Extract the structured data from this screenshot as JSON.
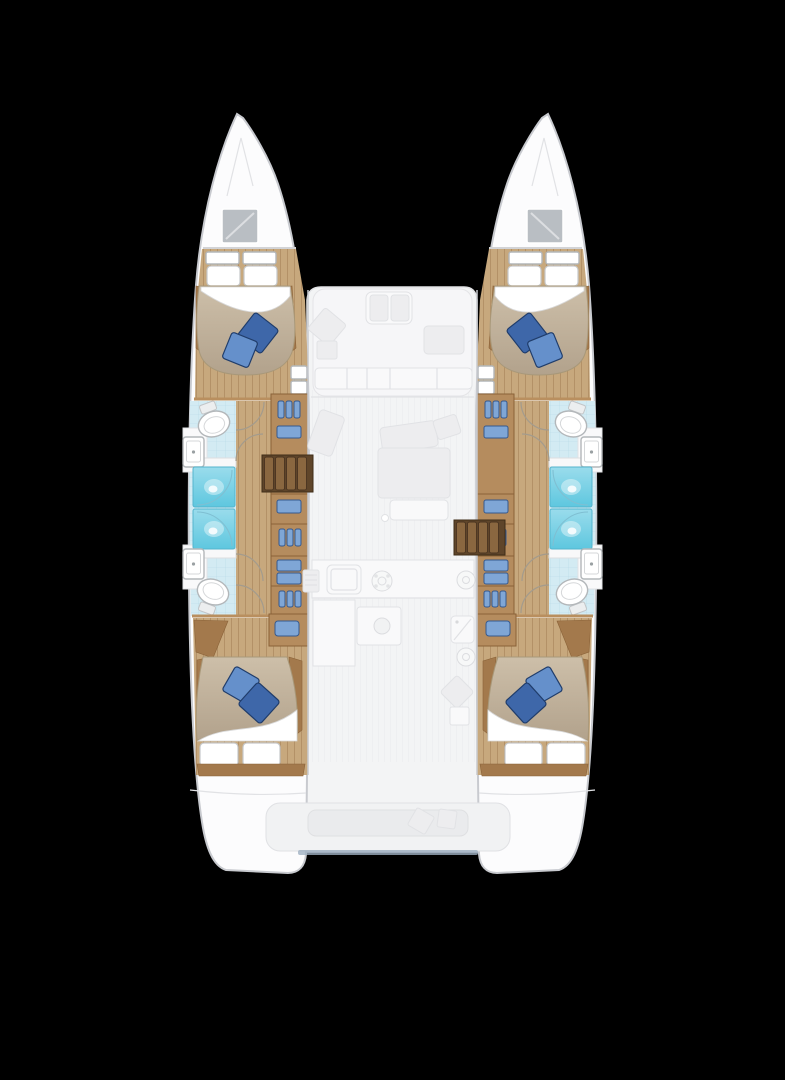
{
  "title": "Catamaran four-cabin lower-deck floor plan, top view on black background",
  "palette": {
    "bg": "#000000",
    "hull-white": "#fcfcfd",
    "hull-stroke": "#c8cacf",
    "ghost-deck": "#f3f4f5",
    "ghost-fill": "#ededef",
    "ghost-line": "#e1e2e5",
    "wood-main": "#b58c5e",
    "wood-dark": "#8a6238",
    "wood-trim": "#a3794c",
    "wood-wall": "#b98f5f",
    "wood-floor": "#c7a87d",
    "plank-line": "#8b6840",
    "stair-dark": "#5f452a",
    "stair-tread": "#8a6740",
    "tile": "#d3ebf3",
    "tile-line": "#9cc8da",
    "shower": "#5ec7df",
    "shower-light": "#9adcec",
    "shower-stroke": "#54b4cd",
    "duvet-light": "#cdbfa9",
    "duvet-dark": "#b2a28c",
    "duvet-stroke": "#a89879",
    "pillow-blue-dark": "#3e67a9",
    "pillow-blue-light": "#6590cb",
    "pillow-blue-edge": "#203d6b",
    "wardrobe-blue": "#7fa6d6",
    "wardrobe-blue-dark": "#35598f",
    "hatch-grey": "#b9bec3",
    "fixture-stroke": "#b3b7ba",
    "door-arc": "#a39b8d",
    "shadow-blue": "#9fb0c2"
  },
  "features": {
    "hulls": 2,
    "cabins": 4,
    "double_beds": 4,
    "blue_pillows_per_bed": 2,
    "white_pillows_per_bed": 2,
    "bathrooms": 4,
    "showers": 4,
    "toilets": 4,
    "sinks": 4,
    "companionway_stairs": 2,
    "wardrobe_columns": 2,
    "bow_hatches": 2
  },
  "ghost_elements": [
    "front cockpit seating",
    "saloon sofa",
    "lounge chairs",
    "galley sink",
    "stove burners",
    "galley island",
    "aft cockpit bench",
    "swim platforms"
  ]
}
